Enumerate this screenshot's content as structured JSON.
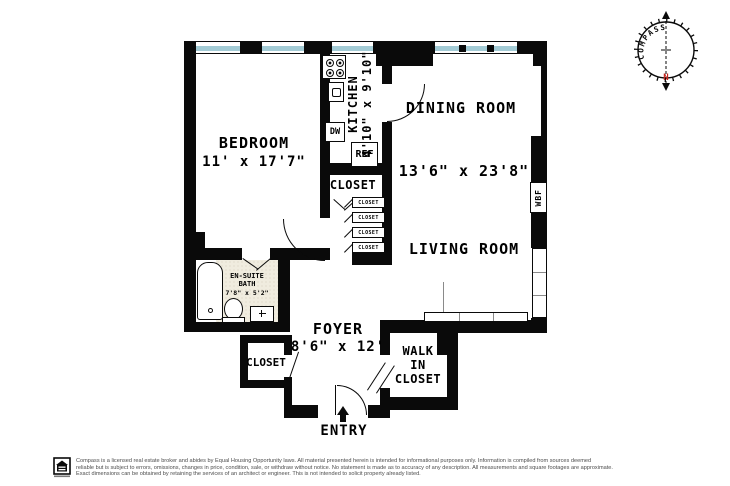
{
  "floor_plan": {
    "bedroom": {
      "name": "BEDROOM",
      "dims": "11' x 17'7\""
    },
    "kitchen": {
      "name": "KITCHEN",
      "dims": "4'10\" x 9'10\"",
      "dishwasher": "DW",
      "refrigerator": "REF"
    },
    "dining_room": {
      "name": "DINING ROOM"
    },
    "living_room": {
      "name": "LIVING ROOM",
      "dims": "13'6\" x 23'8\"",
      "fireplace": "WBF"
    },
    "bath": {
      "line1": "EN-SUITE",
      "line2": "BATH",
      "dims": "7'8\" x 5'2\""
    },
    "foyer": {
      "name": "FOYER",
      "dims": "8'6\" x 12'"
    },
    "walk_in_closet": {
      "line1": "WALK",
      "line2": "IN",
      "line3": "CLOSET"
    },
    "hall_closet": "CLOSET",
    "foyer_closet": "CLOSET",
    "small_closets": [
      "CLOSET",
      "CLOSET",
      "CLOSET",
      "CLOSET"
    ],
    "entry": "ENTRY"
  },
  "compass": {
    "label": "COMPASS",
    "north": "N"
  },
  "colors": {
    "wall": "#0a0a0a",
    "window": "#a3cbd5",
    "bath_floor": "#f0ecdf",
    "north_red": "#c3241c"
  },
  "footer": {
    "line1": "Compass is a licensed real estate broker and abides by Equal Housing Opportunity laws. All material presented herein is intended for informational purposes only. Information is compiled from sources deemed",
    "line2": "reliable but is subject to errors, omissions, changes in price, condition, sale, or withdraw without notice. No statement is made as to accuracy of any description. All measurements and square footages are approximate.",
    "line3": "Exact dimensions can be obtained by retaining the services of an architect or engineer. This is not intended to solicit property already listed."
  }
}
